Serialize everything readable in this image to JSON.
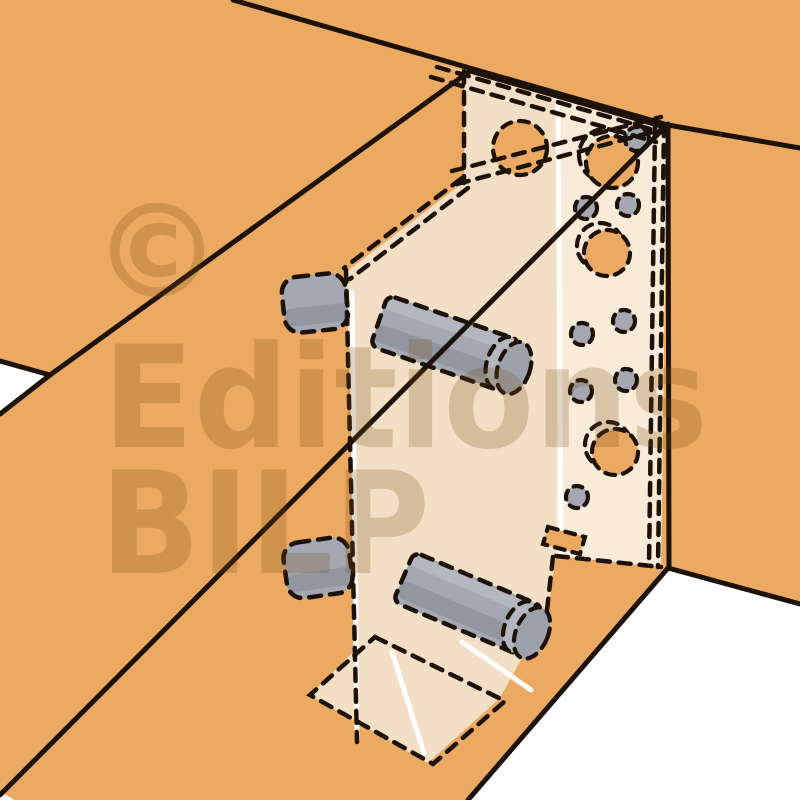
{
  "meta": {
    "description": "Technical cutaway illustration of a concealed metal bracket (hidden joist hanger) joining a wooden secondary beam to a main beam. Hidden bracket plates, dowels and fasteners are drawn with dashed lines; round holes in the nailing plate show wood behind.",
    "diagram_type": "woodworking-joint-cutaway"
  },
  "watermark": {
    "copyright": "©",
    "line1": "Editions",
    "line2": "BILP"
  },
  "palette": {
    "wood_orange": "#ECA962",
    "bracket_light": "#F8EBD8",
    "bracket_shaded": "#F2DFC5",
    "dowel_gray": "#A3A8B2",
    "dowel_gray_dark": "#9196A1",
    "dowel_gray_light": "#B2B7C0",
    "line_black": "#1C1208",
    "background_white": "#FFFFFF",
    "watermark_tint": "#7A4E10",
    "highlight_white": "#FFFFFF"
  }
}
